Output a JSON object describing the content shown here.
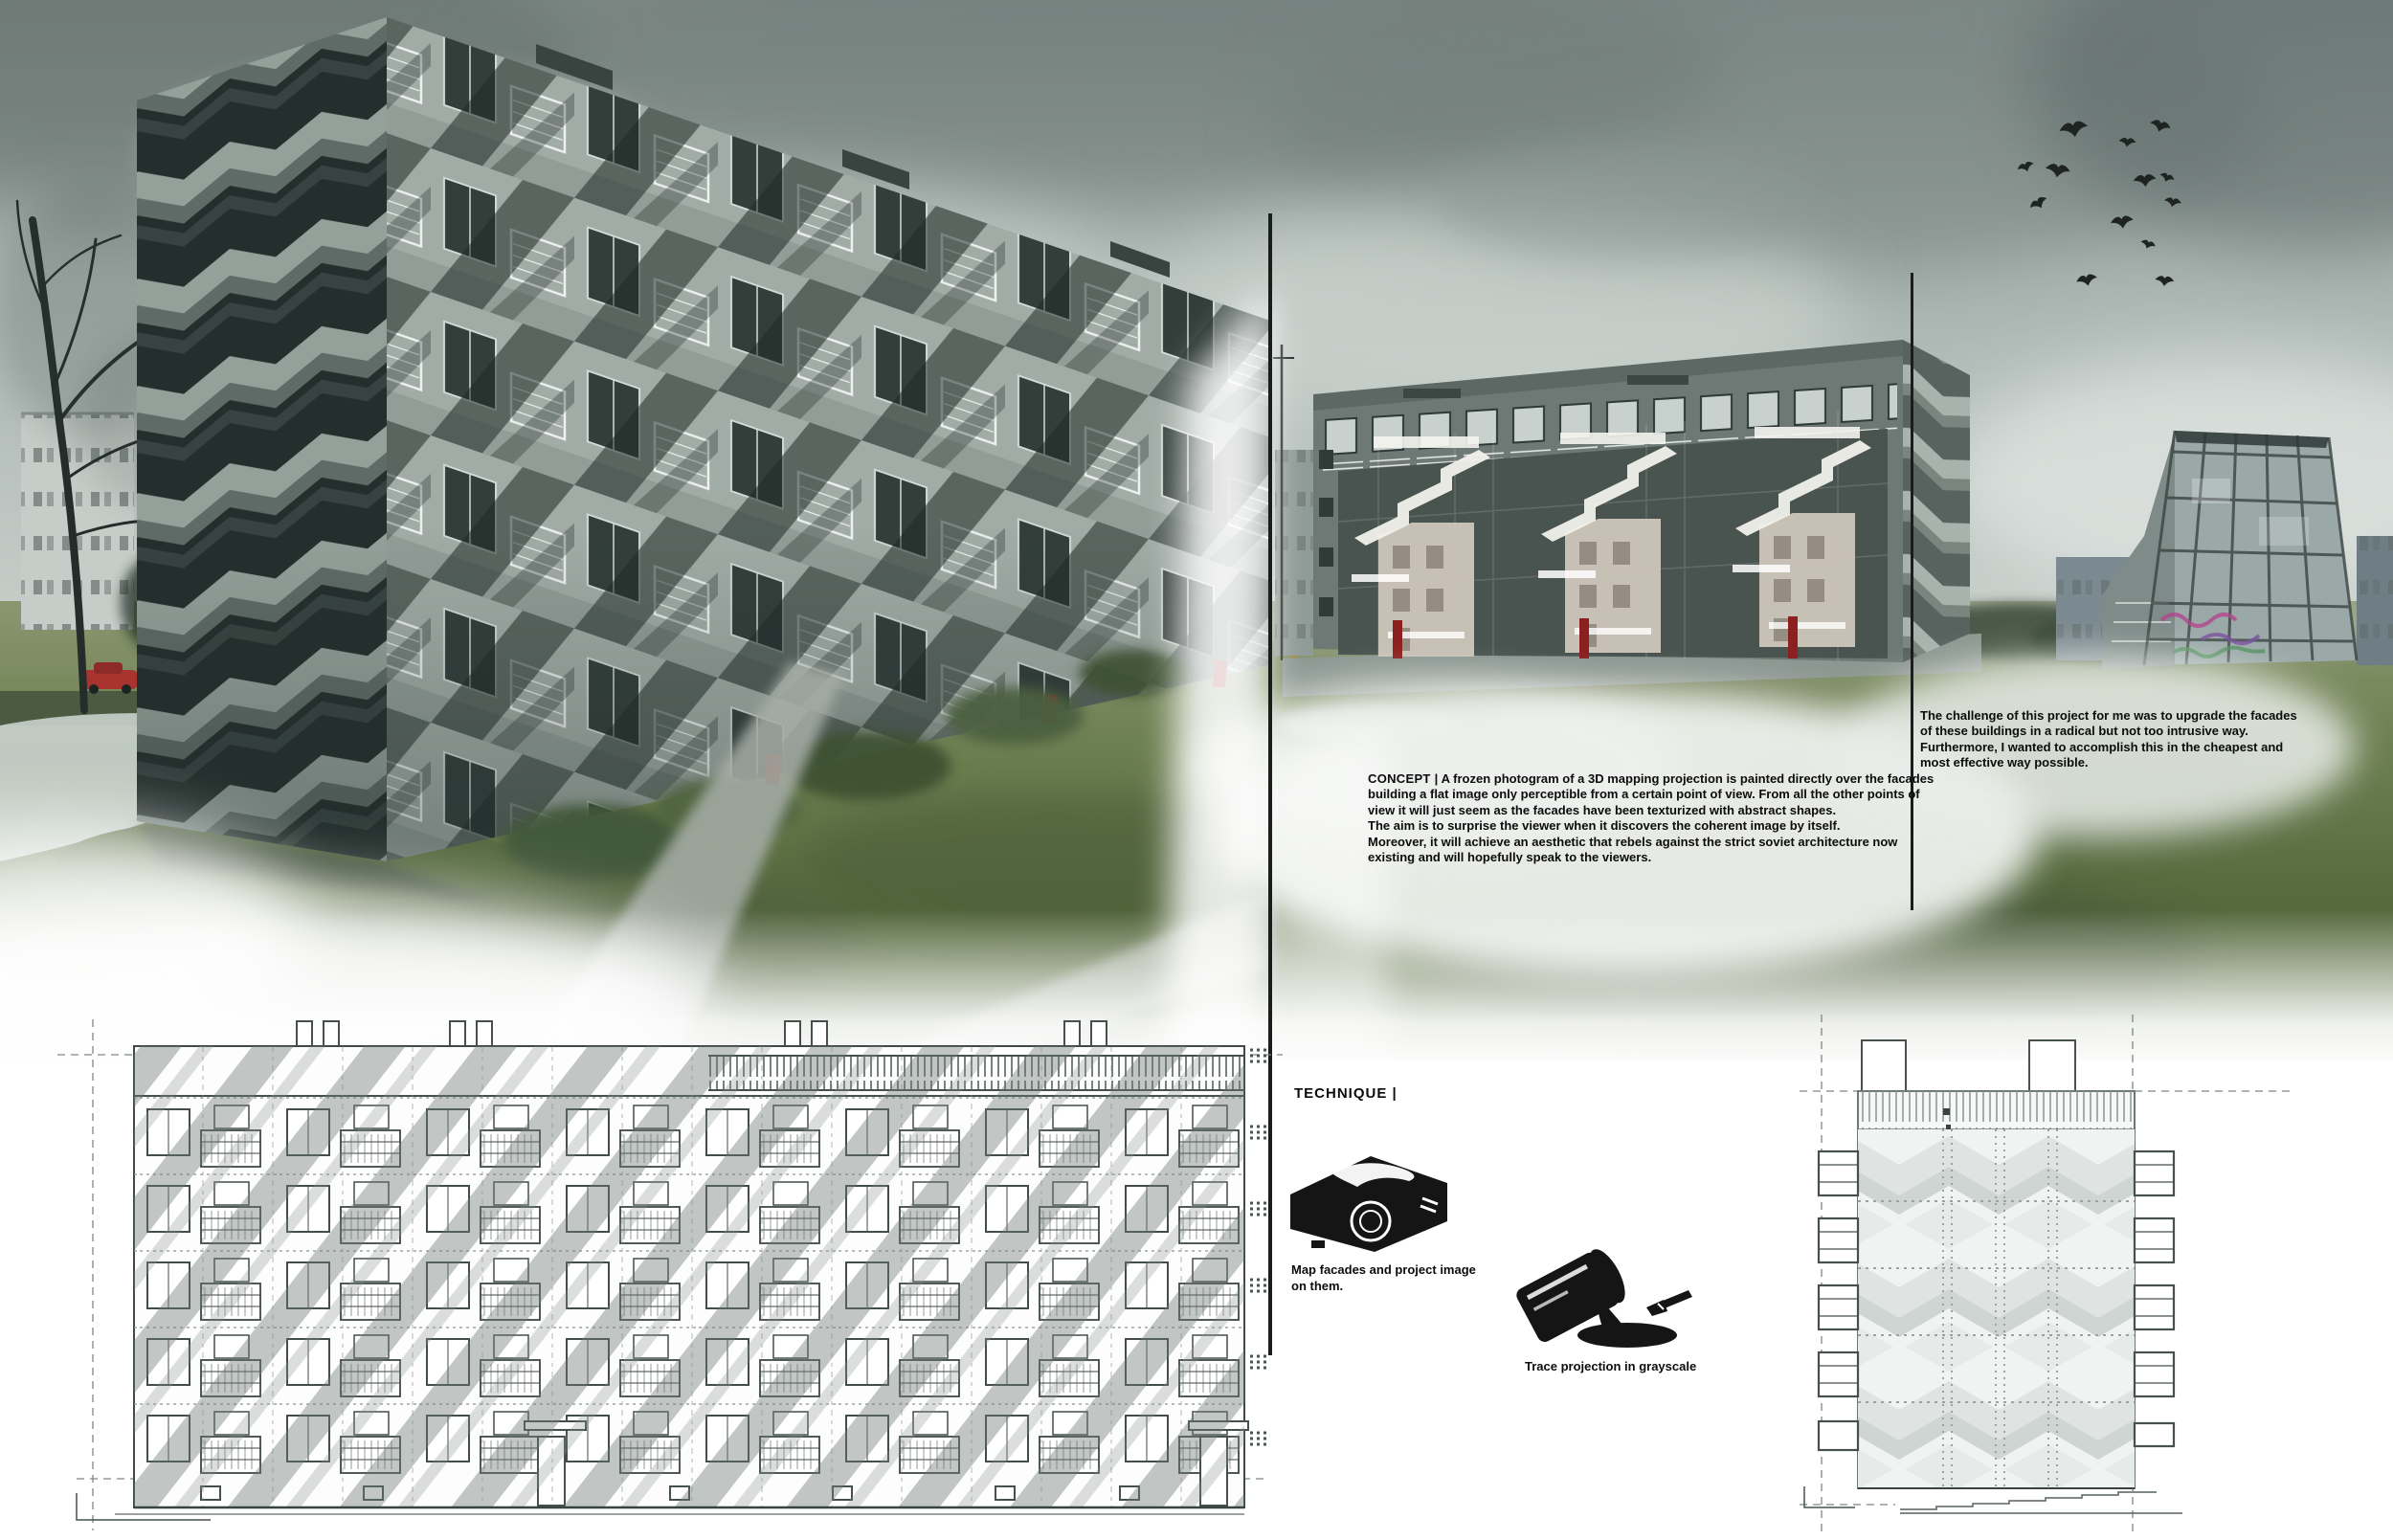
{
  "palette": {
    "background": "#ffffff",
    "divider": "#191d1c",
    "text": "#0c0c0c",
    "accent_red_doors": "#8c2020",
    "sky_dark": "#67736f",
    "sky_light": "#d6dcd8",
    "grass": "#5f7444",
    "concrete": "#a2aca7",
    "drawing_line": "#46514d"
  },
  "concept": {
    "label": "CONCEPT |",
    "body": " A frozen photogram of a 3D mapping projection is painted directly over the facades building a flat image only perceptible from a certain point of view. From all the other points of view it will just seem as the facades have been texturized with abstract shapes.\nThe aim is to surprise the viewer when it discovers the coherent image by itself.\nMoreover, it will achieve an aesthetic that rebels against the strict soviet architecture now existing and will hopefully speak to the viewers."
  },
  "challenge": {
    "body": "The challenge of this project for me was to upgrade the facades of these buildings in a radical but not too intrusive way. Furthermore, I wanted to accomplish this in the cheapest and most effective way possible."
  },
  "technique": {
    "label": "TECHNIQUE |",
    "steps": [
      {
        "icon": "projector-icon",
        "caption": "Map facades and project image\non them."
      },
      {
        "icon": "paint-can-icon",
        "caption": "Trace projection in grayscale"
      }
    ]
  }
}
